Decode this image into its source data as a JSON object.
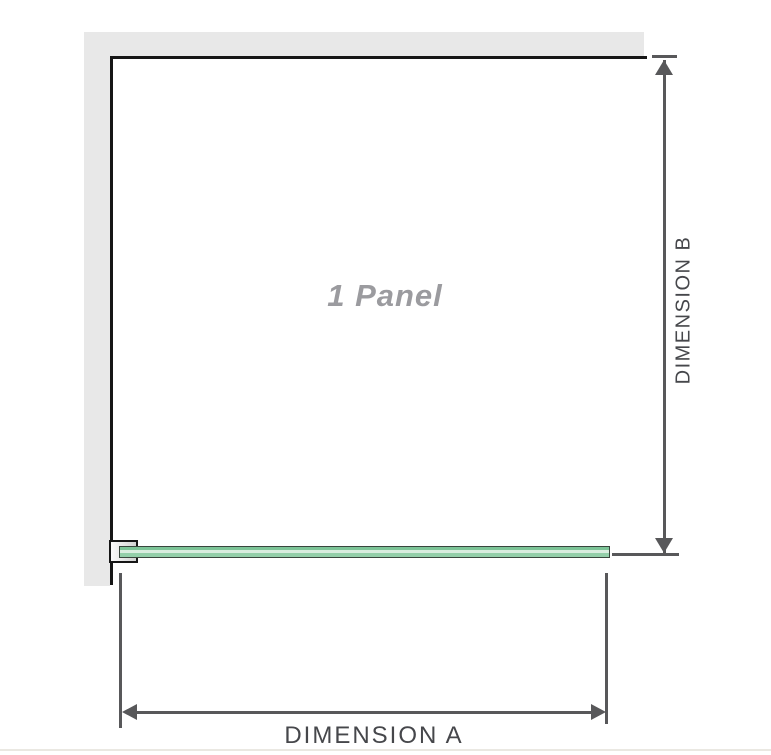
{
  "diagram": {
    "title": "1 panel shower screen dimension diagram",
    "panel": {
      "label": "1 Panel"
    },
    "dimension_a": {
      "label": "DIMENSION A",
      "orientation": "horizontal"
    },
    "dimension_b": {
      "label": "DIMENSION B",
      "orientation": "vertical"
    }
  },
  "colors": {
    "background": "#ffffff",
    "wall": "#e8e8e8",
    "frame_outline": "#161616",
    "dimension_line": "#58585a",
    "dimension_text": "#46474b",
    "panel_text": "#9b9b9f",
    "glass_edge": "#39463d",
    "glass_mid": "#7cc497",
    "glass_light": "#d9eddf",
    "glass_mid2": "#93cfa9",
    "bracket_fill_light": "#fbfbfb",
    "bracket_fill_dark": "#d2d2d2",
    "bottom_rule": "#eae8e2"
  }
}
